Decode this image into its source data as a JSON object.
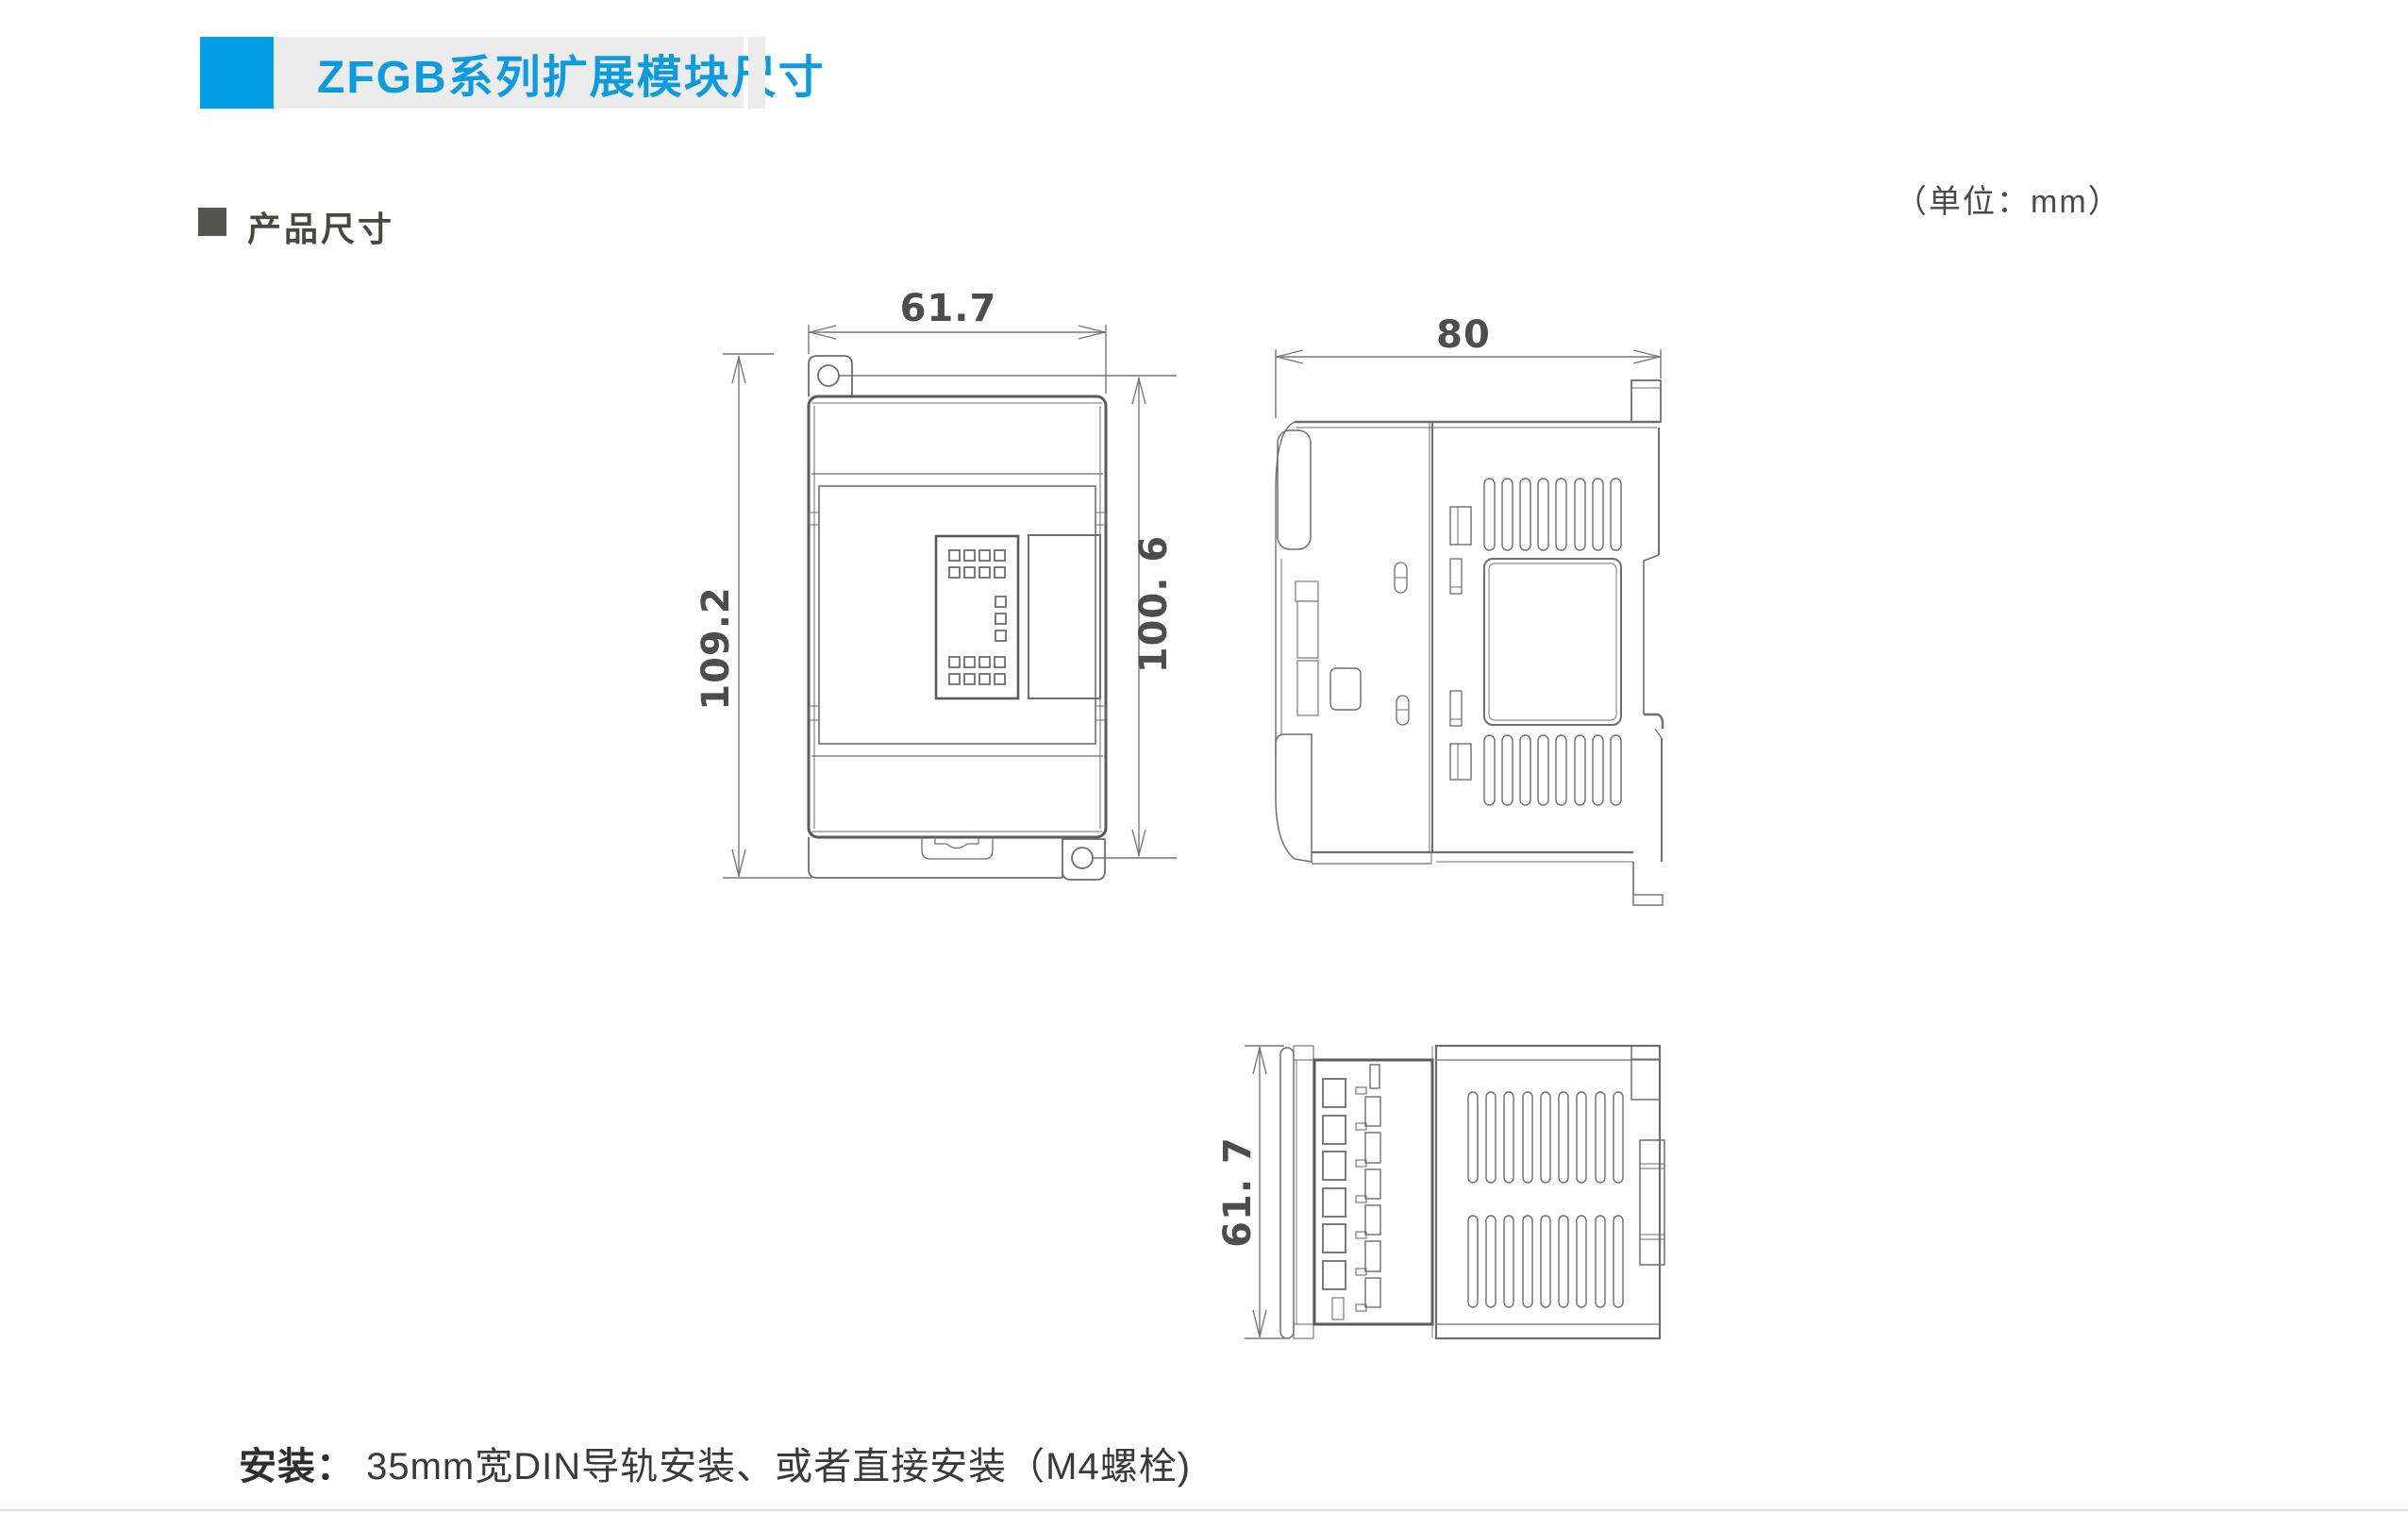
{
  "banner": {
    "title": "ZFGB系列扩展模块尺寸",
    "accent_color": "#049ee7",
    "bar_color": "#ececec"
  },
  "meta": {
    "unit_note": "（单位：mm）"
  },
  "section": {
    "title": "产品尺寸"
  },
  "dimensions": {
    "front_width": "61.7",
    "front_height": "109.2",
    "front_hole_pitch": "100. 6",
    "side_depth": "80",
    "bottom_width": "61. 7"
  },
  "footer": {
    "label": "安装：",
    "text": " 35mm宽DIN导轨安装、或者直接安装（M4螺栓)"
  },
  "colors": {
    "line": "#6e6e6e",
    "dark_line": "#5a5a5a",
    "text": "#4a4a4a"
  }
}
